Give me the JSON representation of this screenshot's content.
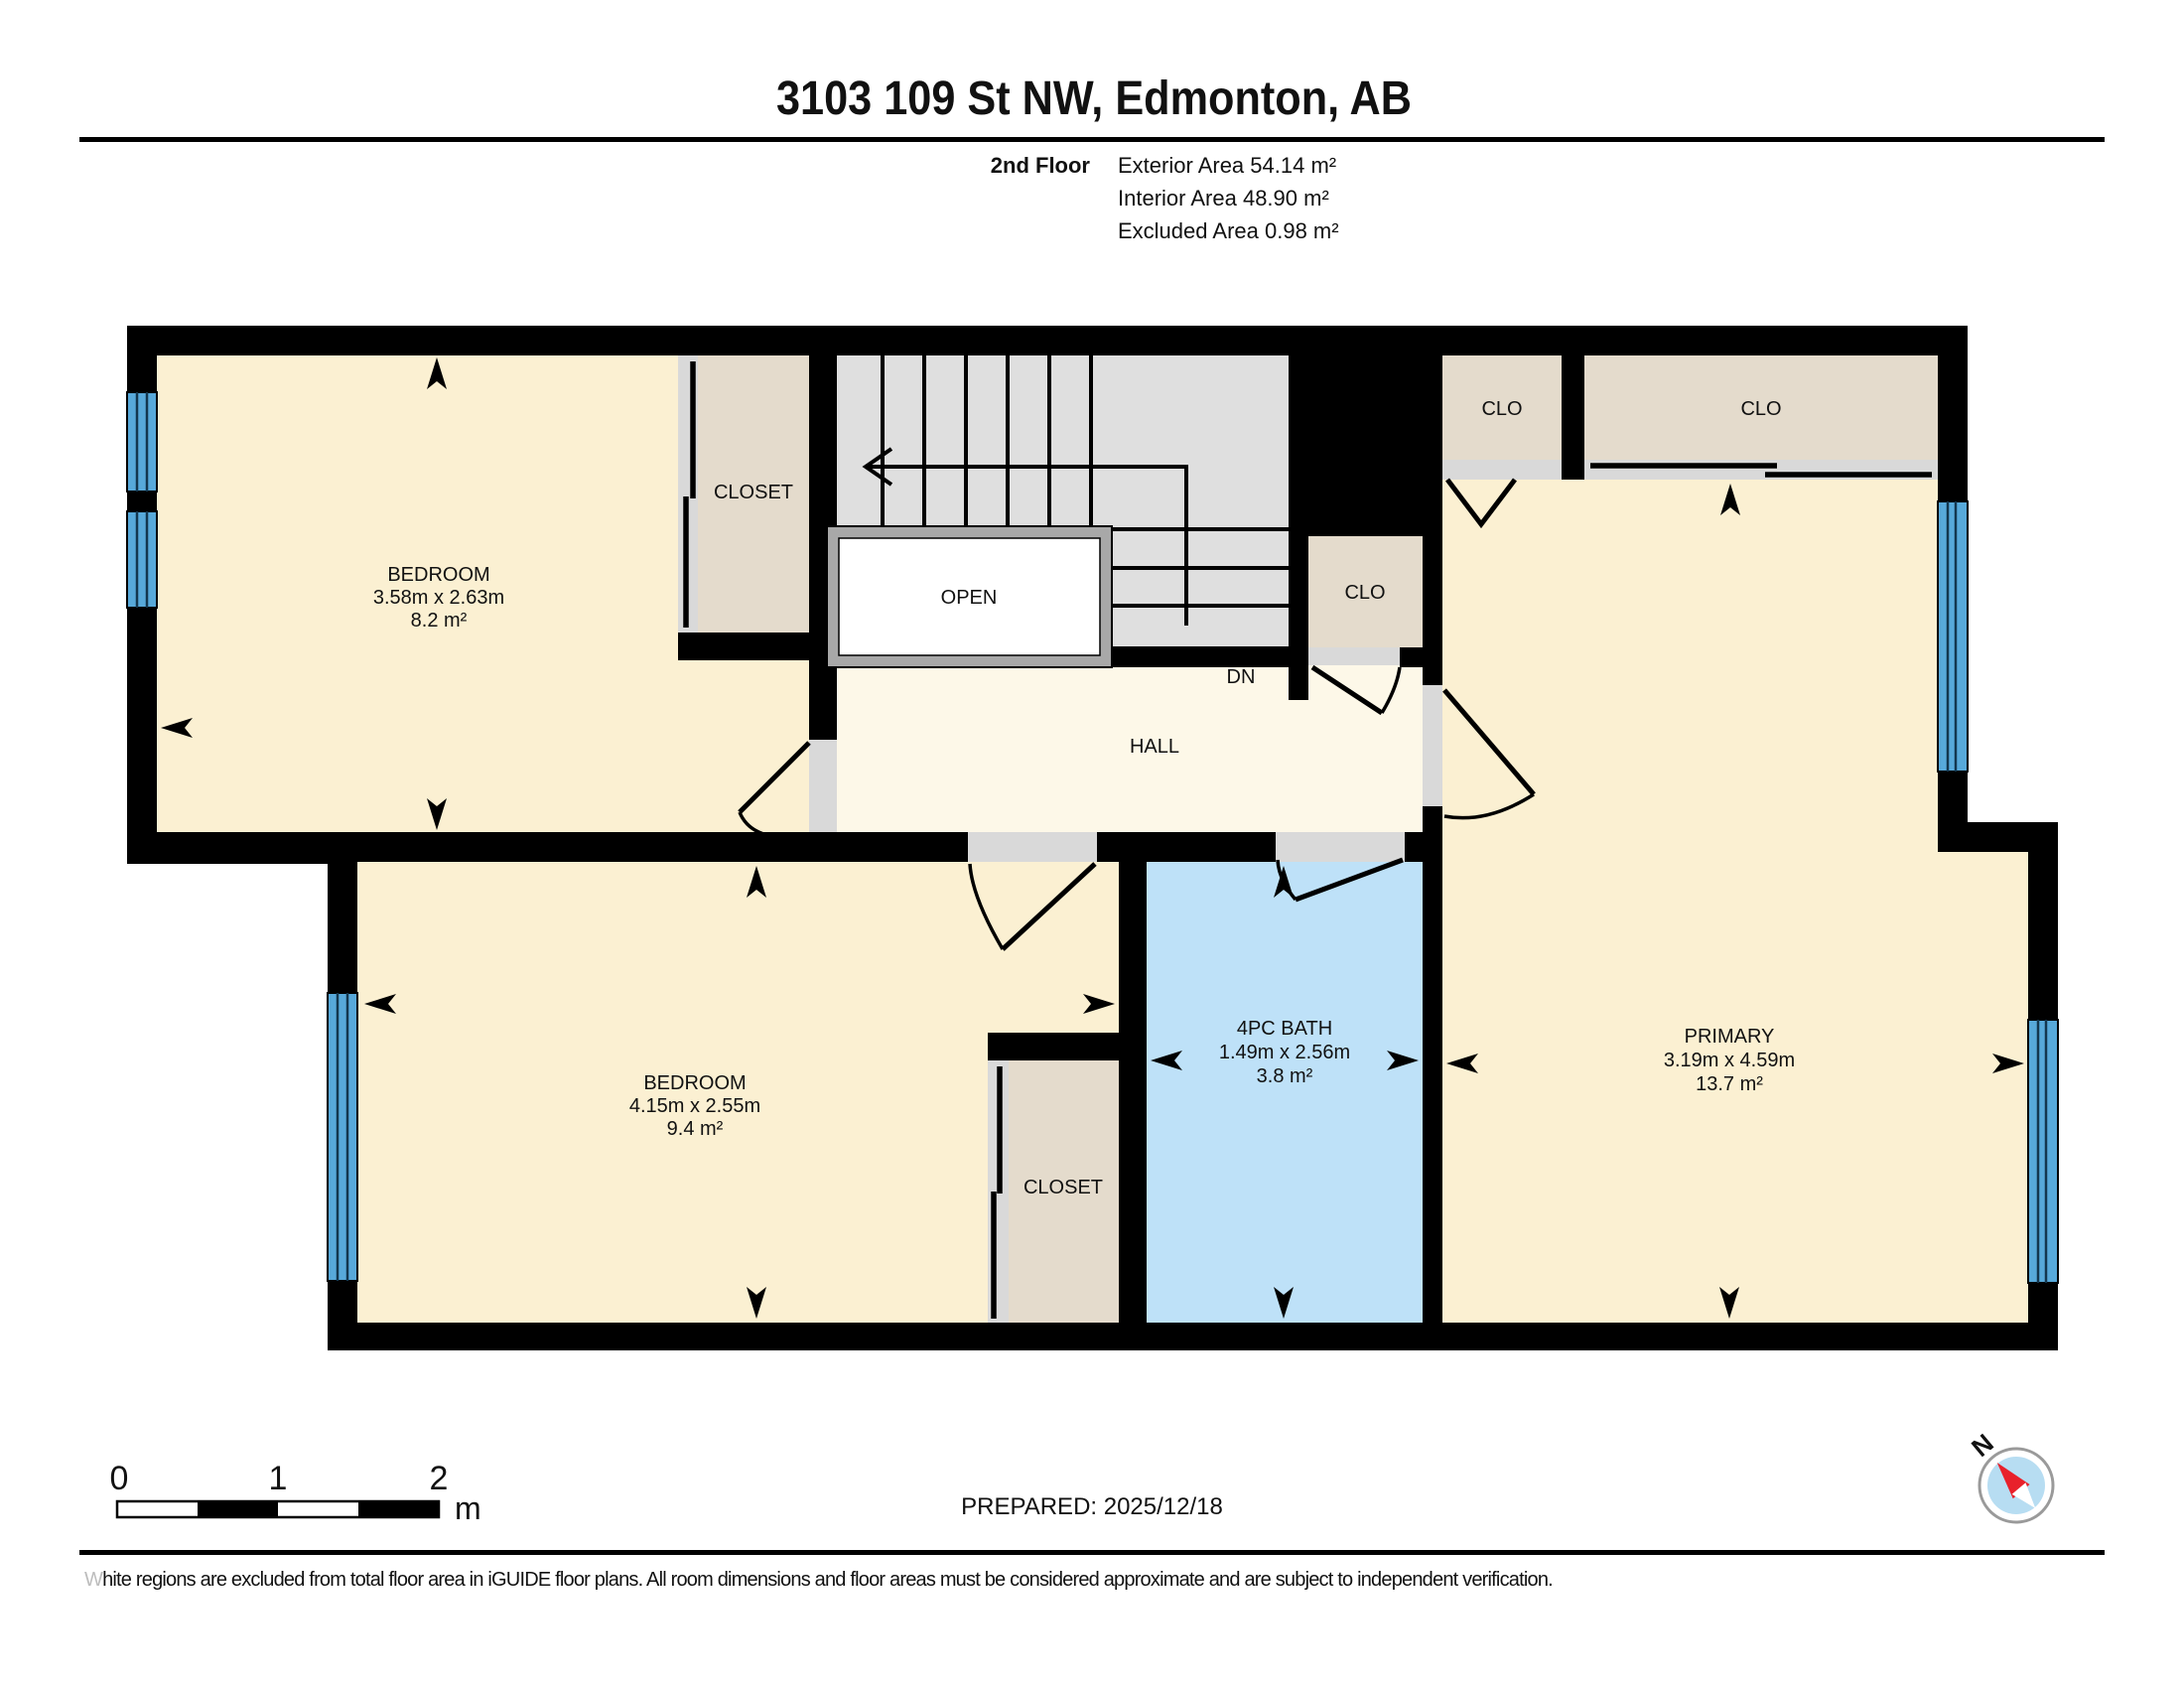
{
  "header": {
    "title": "3103 109 St NW, Edmonton, AB",
    "floor_label": "2nd Floor",
    "stats": {
      "exterior": "Exterior Area 54.14 m²",
      "interior": "Interior Area 48.90 m²",
      "excluded": "Excluded Area 0.98 m²"
    }
  },
  "rooms": {
    "bedroom1": {
      "name": "BEDROOM",
      "dims": "3.58m x 2.63m",
      "area": "8.2 m²"
    },
    "bedroom2": {
      "name": "BEDROOM",
      "dims": "4.15m x 2.55m",
      "area": "9.4 m²"
    },
    "primary": {
      "name": "PRIMARY",
      "dims": "3.19m x 4.59m",
      "area": "13.7 m²"
    },
    "bath": {
      "name": "4PC BATH",
      "dims": "1.49m x 2.56m",
      "area": "3.8 m²"
    },
    "hall_label": "HALL",
    "open_label": "OPEN",
    "dn_label": "DN",
    "closet1_label": "CLOSET",
    "closet2_label": "CLOSET",
    "clo_top_left": "CLO",
    "clo_top_right": "CLO",
    "clo_mid": "CLO"
  },
  "scale_bar": {
    "tick0": "0",
    "tick1": "1",
    "tick2": "2",
    "unit": "m"
  },
  "footer": {
    "prepared": "PREPARED: 2025/12/18",
    "disclaimer_first": "W",
    "disclaimer_rest": "hite regions are excluded from total floor area in iGUIDE floor plans. All room dimensions and floor areas must be considered approximate and are subject to independent verification.",
    "compass_n": "N"
  },
  "colors": {
    "room": "#FBF0D2",
    "hall": "#FDF8E8",
    "closet": "#E4DBCC",
    "bath": "#BEE1F8",
    "stairs": "#DFDFDF",
    "window": "#57A9DA",
    "open_border": "#A8A8A8",
    "opening": "#D9D9D9",
    "compass_red": "#E8212B",
    "compass_blue": "#B7DDF2"
  }
}
